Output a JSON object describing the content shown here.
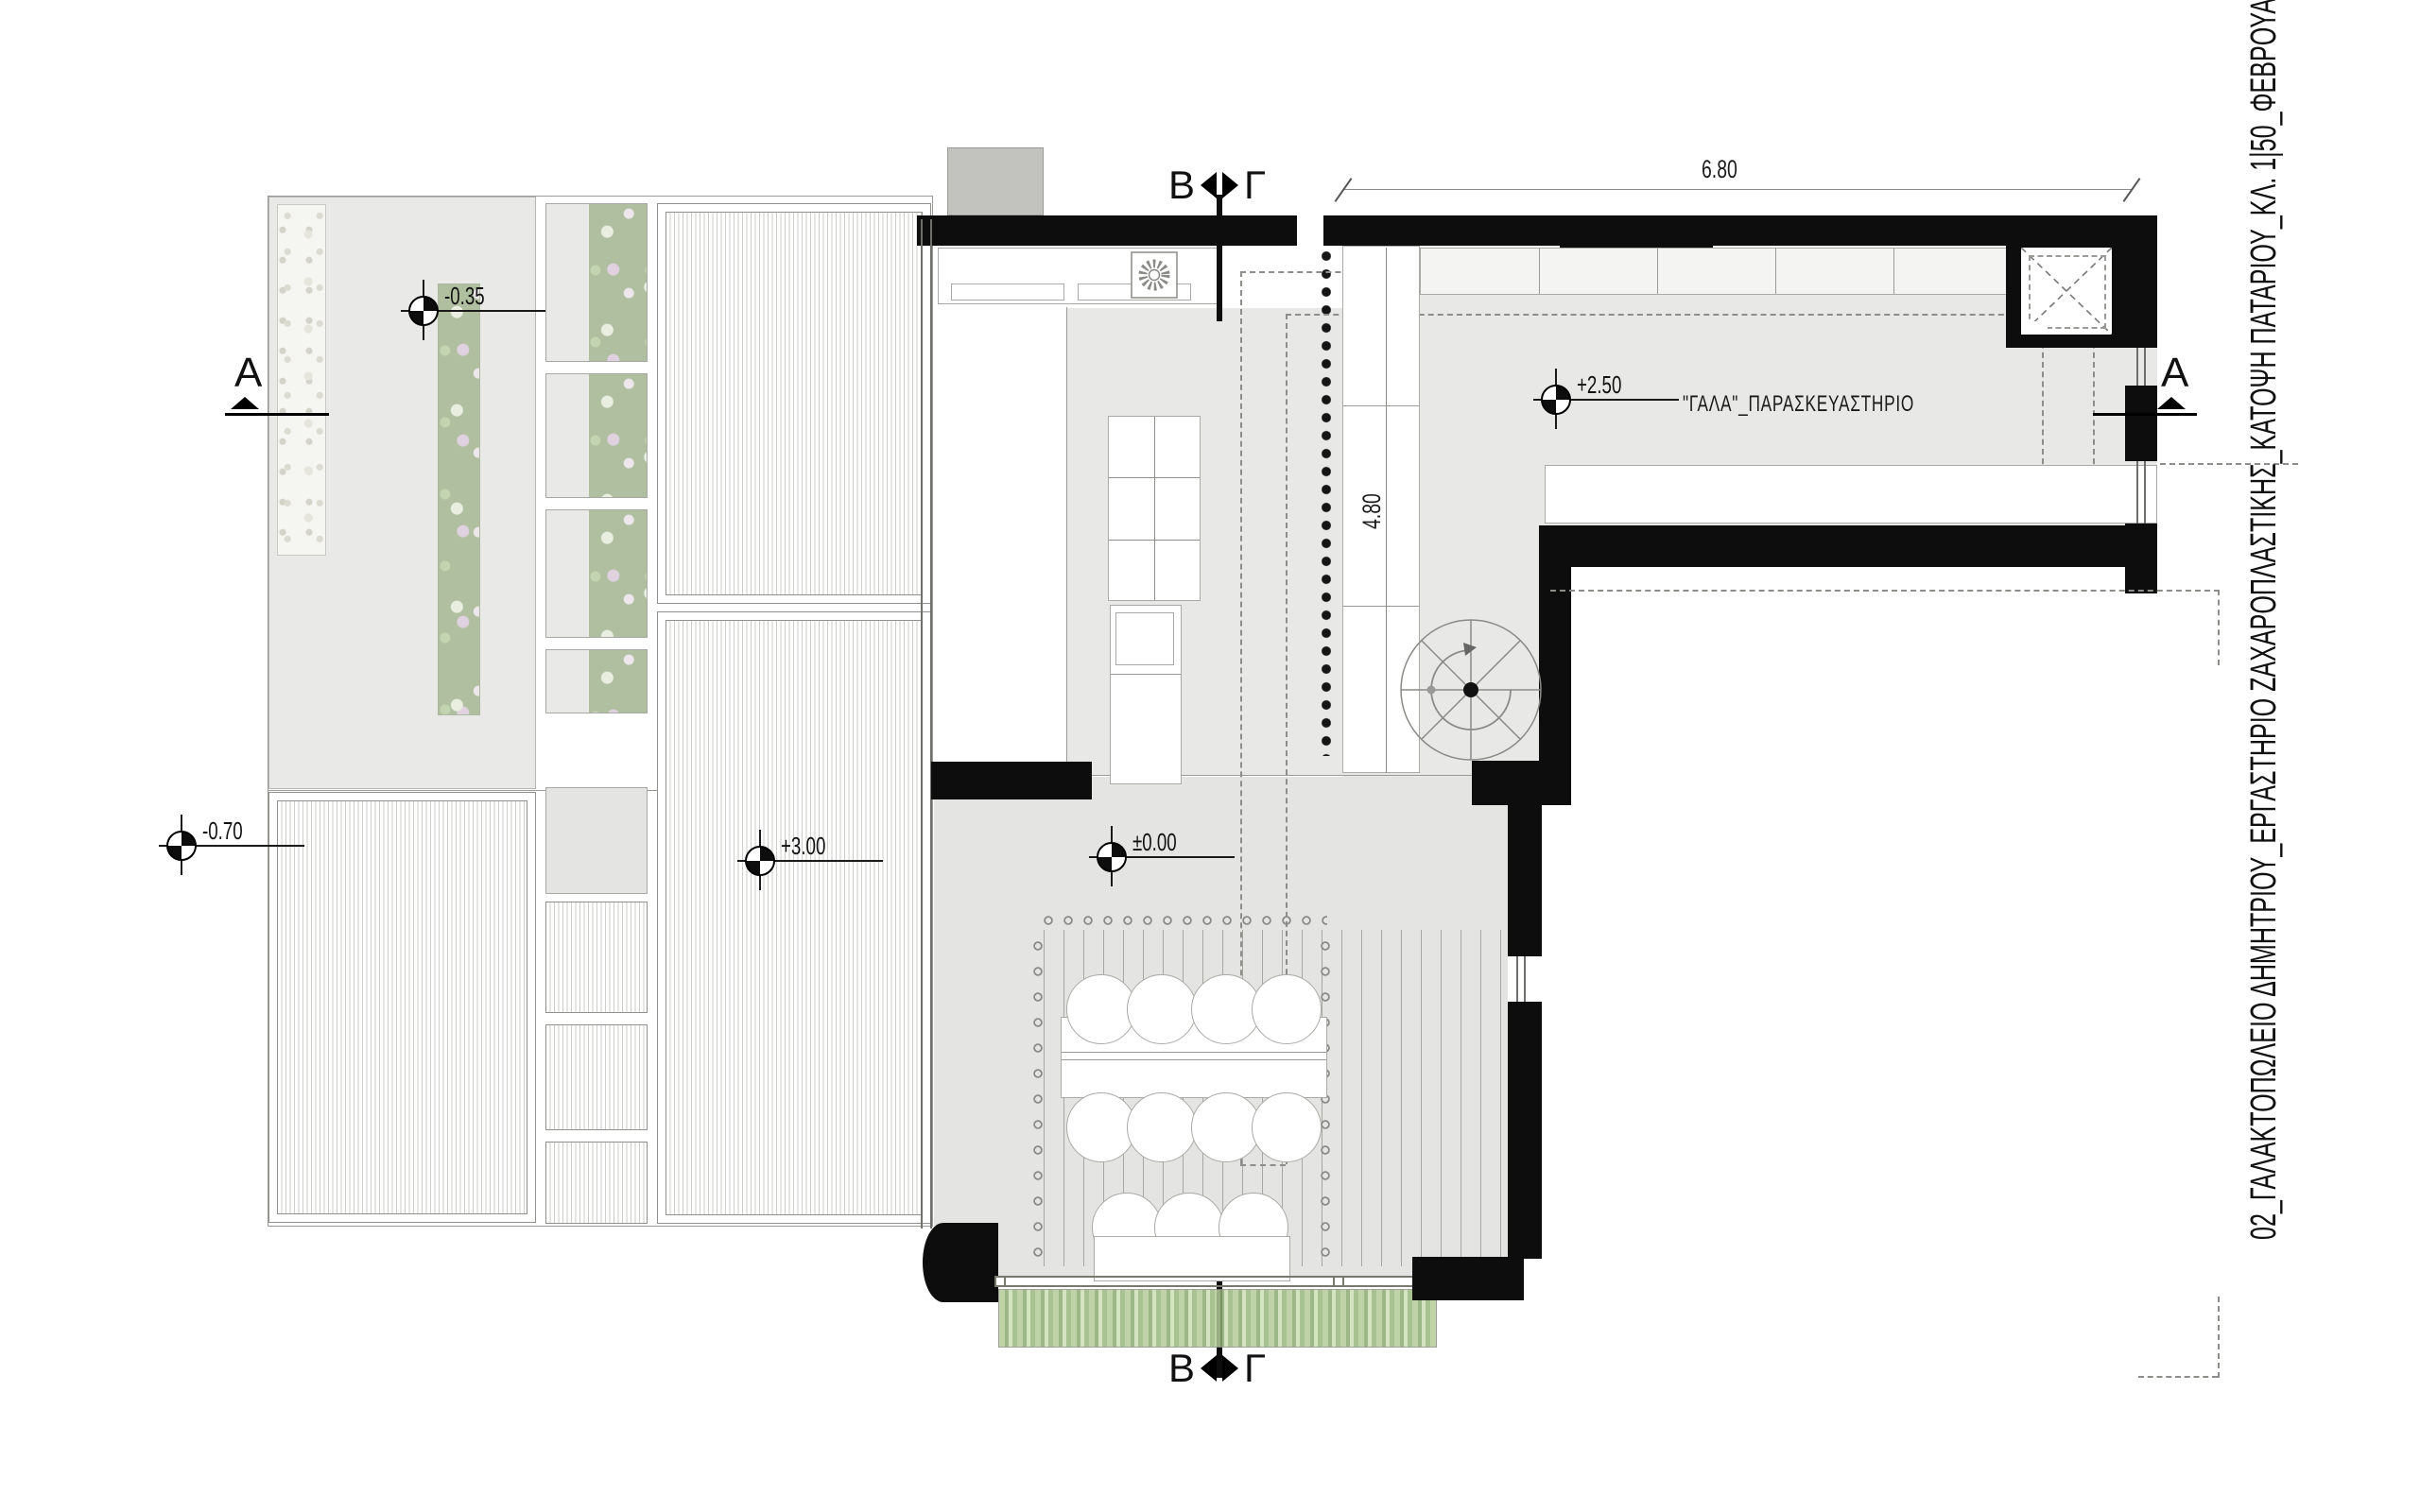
{
  "drawing": {
    "title": "02_ΓΑΛΑΚΤΟΠΩΛΕΙΟ ΔΗΜΗΤΡΙΟΥ_ΕΡΓΑΣΤΗΡΙΟ ΖΑΧΑΡΟΠΛΑΣΤΙΚΗΣ_ΚΑΤΟΨΗ ΠΑΤΑΡΙΟΥ_ΚΛ. 1|50_ΦΕΒΡΟΥΑΡΙΟΣ 2016",
    "room_label": "\"ΓΑΛΑ\"_ΠΑΡΑΣΚΕΥΑΣΤΗΡΙΟ",
    "dimensions": {
      "top_width": "6.80",
      "counter_depth": "4.80"
    },
    "levels": {
      "courtyard": "-0.35",
      "street": "-0.70",
      "roof_deck": "+3.00",
      "mezzanine": "+2.50",
      "ground": "±0.00"
    },
    "section_markers": {
      "a": "Α",
      "b": "Β",
      "g": "Γ"
    },
    "colors": {
      "wall": "#0d0d0d",
      "floor": "#e8e8e6",
      "line": "#9a9a96",
      "planting": "#9cb187",
      "bamboo": "#a4c189",
      "paper": "#ffffff"
    }
  }
}
